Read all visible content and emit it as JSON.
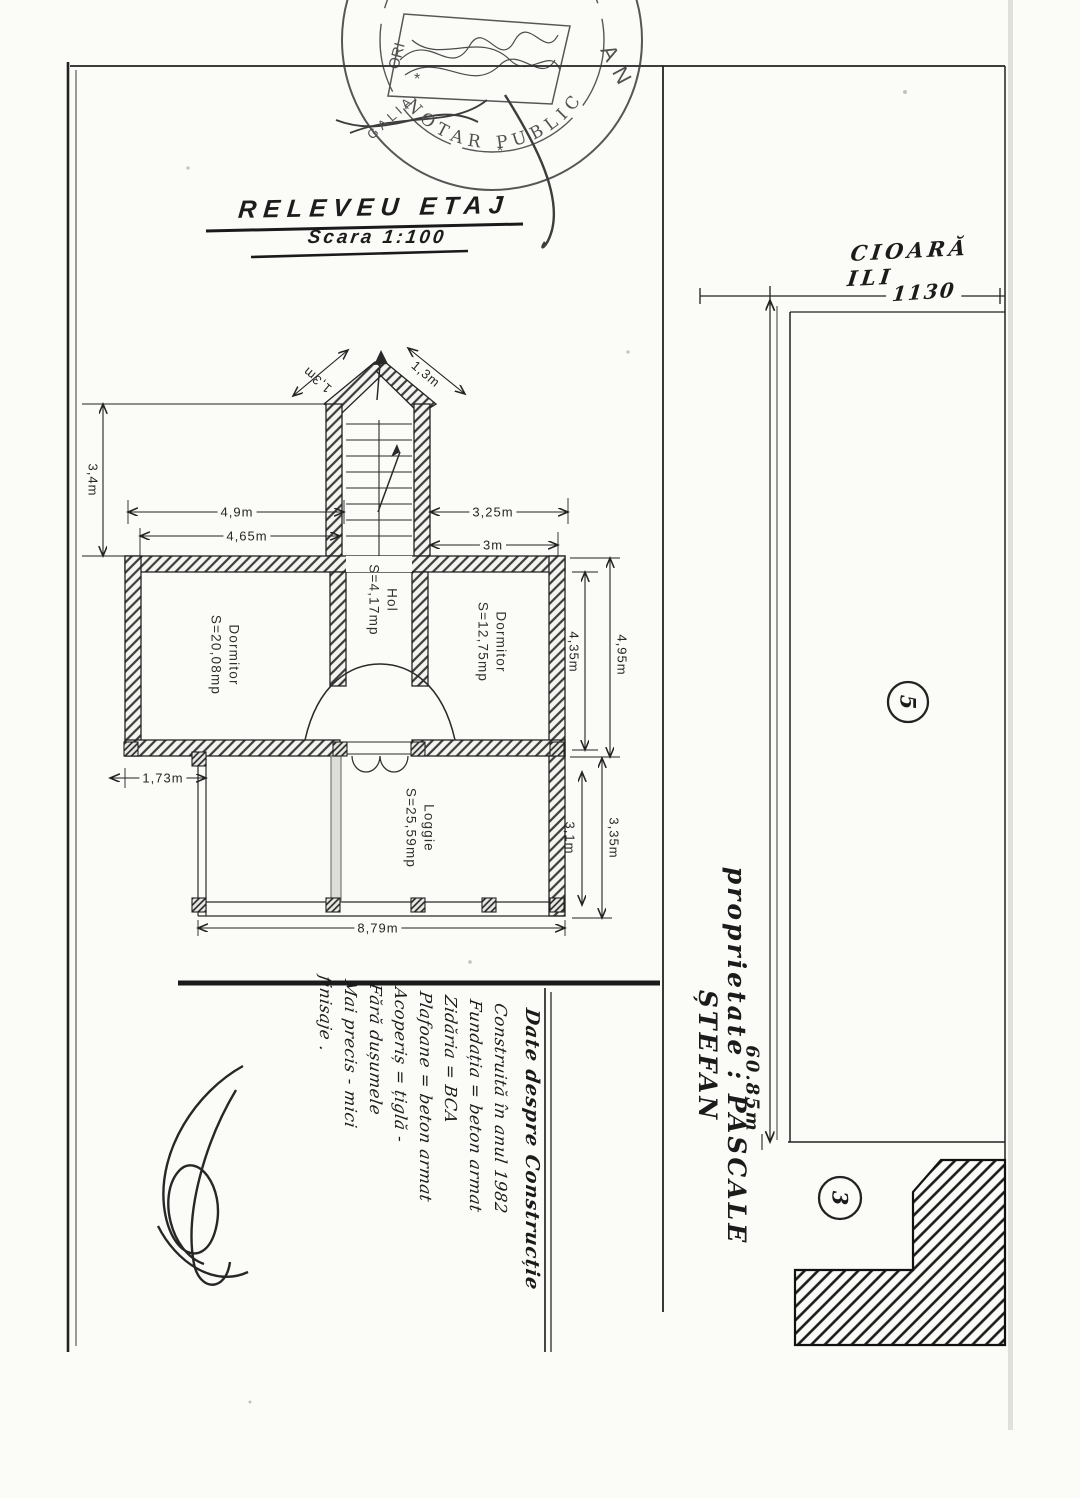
{
  "title_block": {
    "title": "RELEVEU ETAJ",
    "scale": "Scara 1:100"
  },
  "stamp": {
    "arc_text": "NOTAR PUBLIC",
    "left_letters": "ORI",
    "left_letters2": "GALIA",
    "right_letters": "AN",
    "star": "*"
  },
  "floor_plan": {
    "rooms": [
      {
        "name": "Dormitor",
        "area": "S=20,08mp"
      },
      {
        "name": "Hol",
        "area": "S=4,17mp"
      },
      {
        "name": "Dormitor",
        "area": "S=12,75mp"
      },
      {
        "name": "Loggie",
        "area": "S=25,59mp"
      }
    ],
    "dims": {
      "roof_left": "1,3m",
      "roof_right": "1,3m",
      "left_height": "3,4m",
      "top_outer": "4,9m",
      "top_inner": "4,65m",
      "top_right_outer": "3,25m",
      "top_right_inner": "3m",
      "right_outer": "4,95m",
      "right_inner": "4,35m",
      "offset_left": "1,73m",
      "loggia_right_outer": "3,35m",
      "loggia_right_inner": "3,1m",
      "loggia_width": "8,79m"
    }
  },
  "site_plan": {
    "neighbor": "CIOARĂ ILI",
    "front_width": "1130",
    "depth": "60.85m",
    "owner": "proprietate : PASCALE  ȘTEFAN",
    "parcel_5": "5",
    "parcel_3": "3"
  },
  "notes": {
    "heading": "Date despre Construcție",
    "lines": [
      "Construită în anul 1982",
      "Fundația = beton armat",
      "Zidăria = BCA",
      "Plafoane = beton armat",
      "Acoperiș = țiglă -",
      "Fără dușumele",
      "Mai precis - mici",
      "finisaje ."
    ]
  }
}
